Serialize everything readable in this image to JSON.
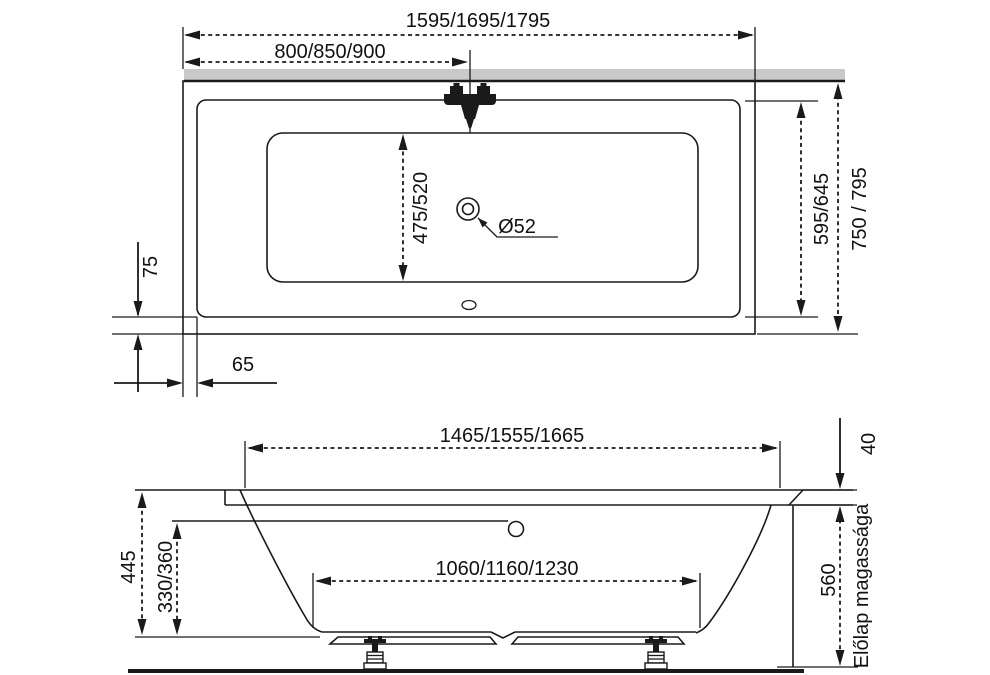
{
  "drawing_title": "Bathtub dimensional drawing",
  "colors": {
    "line": "#1a1a1a",
    "wall_band": "#c9c9c9",
    "background": "#ffffff"
  },
  "top_view": {
    "overall_length": "1595/1695/1795",
    "faucet_position": "800/850/900",
    "interior_width": "475/520",
    "drain_diameter": "Ø52",
    "inner_width": "595/645",
    "overall_width": "750 / 795",
    "rim_overhang_bottom": "75",
    "rim_overhang_left": "65"
  },
  "side_view": {
    "upper_length": "1465/1555/1665",
    "rim_thickness": "40",
    "bottom_length": "1060/1160/1230",
    "tub_height": "445",
    "interior_depth": "330/360",
    "front_panel_height": "560",
    "front_panel_label": "Előlap magassága"
  }
}
